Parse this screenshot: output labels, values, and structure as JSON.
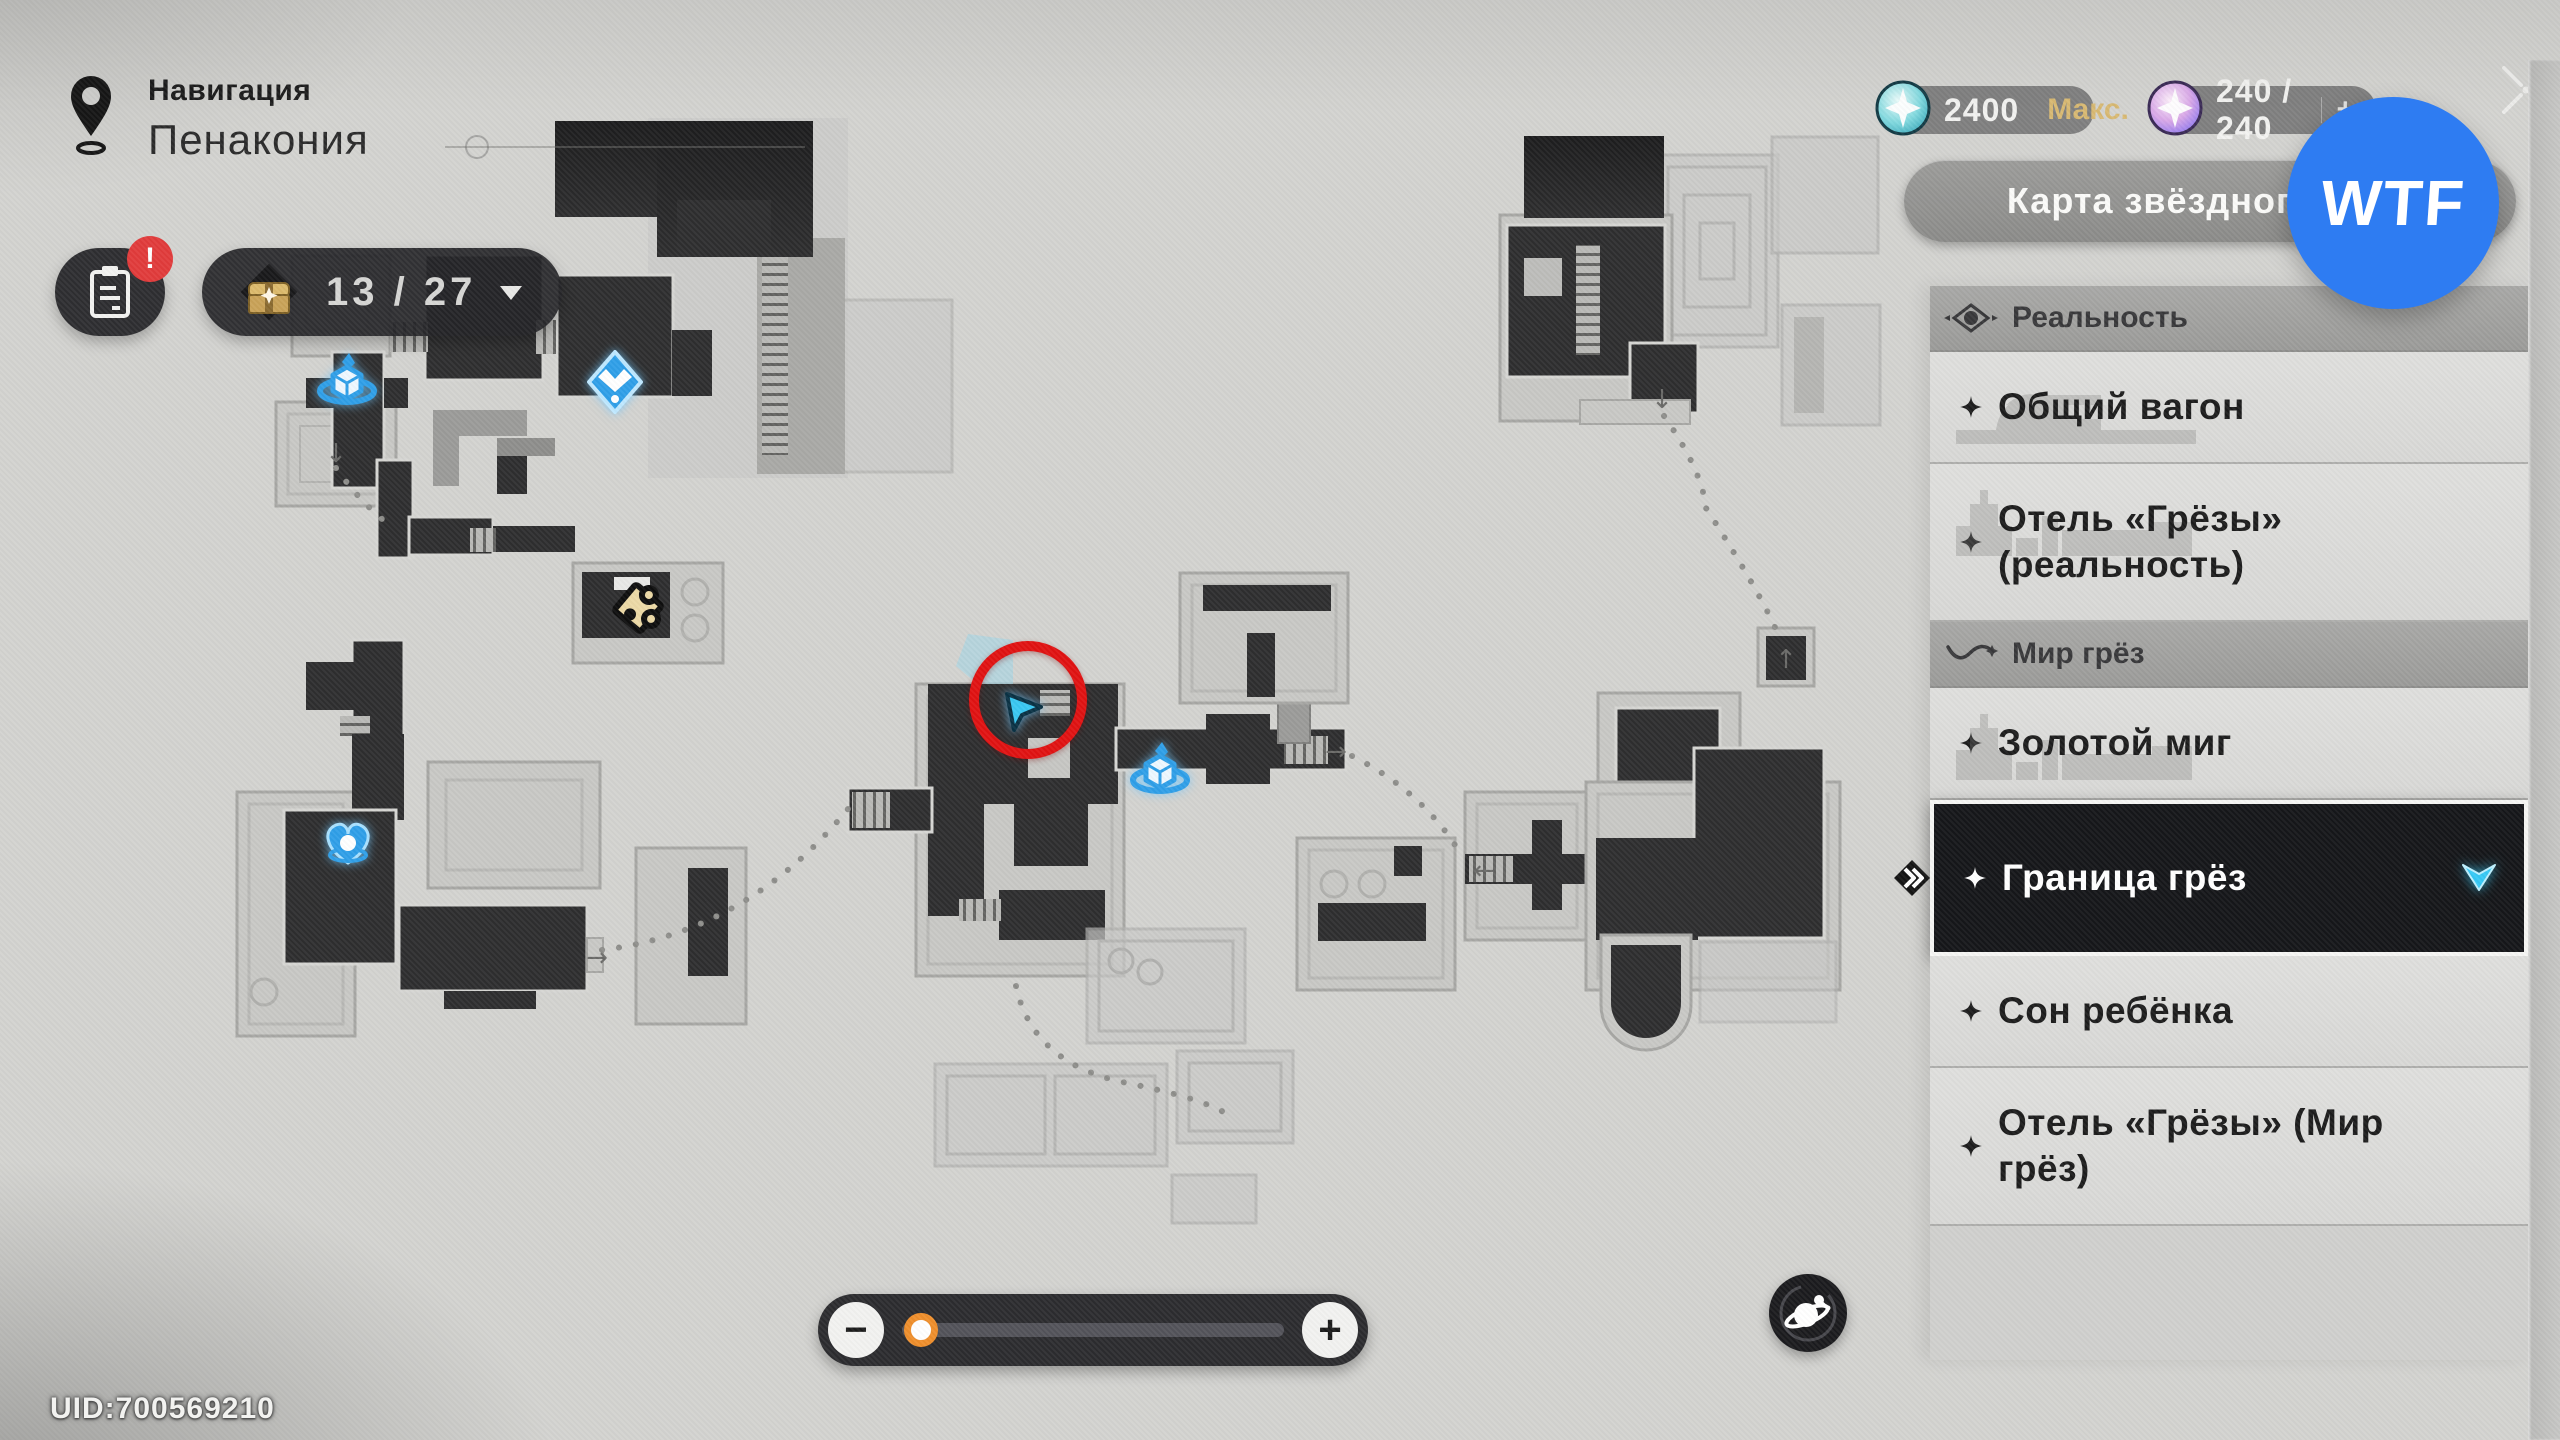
{
  "header": {
    "nav_label": "Навигация",
    "region_title": "Пенакония"
  },
  "hud": {
    "quest_button": {
      "badge": "!"
    },
    "chest_counter": {
      "count": "13 / 27"
    },
    "currencies": [
      {
        "value": "2400",
        "suffix": "Макс."
      },
      {
        "value": "240 / 240",
        "suffix": "+"
      }
    ]
  },
  "watermark": {
    "label": "WTF"
  },
  "sidebar": {
    "map_switch_button": {
      "label": "Карта звёздного неба",
      "chevron": "›"
    },
    "rows": [
      {
        "type": "header",
        "id": "reality",
        "label": "Реальность",
        "icon": "reality-eye"
      },
      {
        "type": "item",
        "id": "obshchiy-vagon",
        "label": "Общий вагон",
        "silhouette": "train"
      },
      {
        "type": "item",
        "id": "otel-grezy-realnost",
        "label": "Отель «Грёзы» (реальность)",
        "lines": 2,
        "silhouette": "city"
      },
      {
        "type": "header",
        "id": "dream-world",
        "label": "Мир грёз",
        "icon": "dream-wave"
      },
      {
        "type": "item",
        "id": "zolotoy-mig",
        "label": "Золотой миг",
        "silhouette": "city"
      },
      {
        "type": "item",
        "id": "granitsa-grez",
        "label": "Граница грёз",
        "selected": true
      },
      {
        "type": "item",
        "id": "son-rebenka",
        "label": "Сон ребёнка"
      },
      {
        "type": "item",
        "id": "otel-grezy-mir-grez",
        "label": "Отель «Грёзы» (Мир грёз)",
        "lines": 2
      }
    ]
  },
  "map": {
    "markers": [
      {
        "type": "space-anchor",
        "x": 347,
        "y": 383
      },
      {
        "type": "waypoint",
        "x": 615,
        "y": 382
      },
      {
        "type": "puzzle",
        "x": 638,
        "y": 608
      },
      {
        "type": "dream-heart",
        "x": 348,
        "y": 843
      },
      {
        "type": "space-anchor",
        "x": 1160,
        "y": 772
      },
      {
        "type": "player-cursor",
        "x": 1023,
        "y": 712
      }
    ],
    "annotation_circle": {
      "x": 1028,
      "y": 700,
      "r": 54
    },
    "zoom_slider": {
      "minus": "−",
      "plus": "+",
      "position_pct": 5
    }
  },
  "footer": {
    "uid": "UID:700569210"
  },
  "colors": {
    "wtf_blue": "#2e7cf2",
    "annotation_red": "#e01212",
    "marker_blue": "#2f9fe8",
    "cursor_cyan": "#3ac8f2",
    "gold_text": "#d8b972",
    "selected_bg": "#151619",
    "knob_orange": "#ef8f2c",
    "badge_red": "#e13b3b"
  }
}
